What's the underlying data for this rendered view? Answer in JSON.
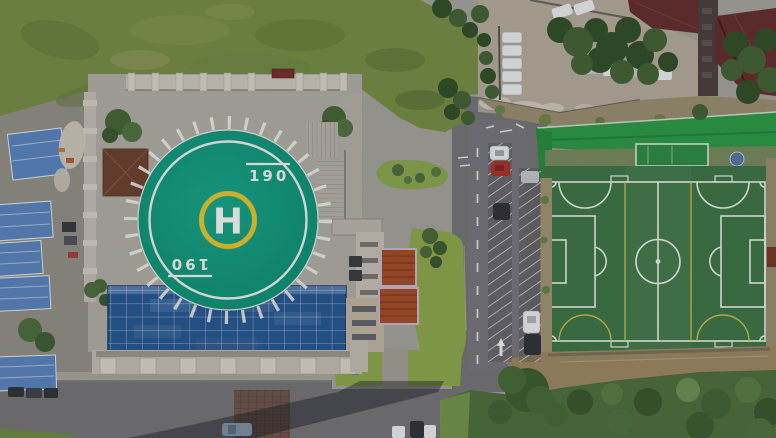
{
  "scene": {
    "kind": "aerial-drone-photo",
    "helipad": {
      "letter": "H",
      "heading_mark": "190"
    },
    "colors": {
      "base": "#a9a69f",
      "left_ground": "#96938c",
      "grass": "#7a9049",
      "lawn": "#92ab51",
      "island_green": "#8cab52",
      "turf": "#41784a",
      "line_white": "#eef3ea",
      "line_yellow": "#d8c94f",
      "enclosure_green": "#2f9d4b",
      "surround_green": "#7b8d60",
      "plaza": "#b3b0a9",
      "balustrade": "#cfcbc2",
      "stone_light": "#dad6cd",
      "helipad_teal": "#14997f",
      "helipad_yellow": "#e9c832",
      "glass_blue": "#2a5b95",
      "shed_blue": "#5d87c3",
      "maroon_roof": "#693131",
      "pagoda_orange": "#a9512c",
      "pavilion_brown": "#6f4533",
      "asphalt": "#78777b",
      "sidewalk": "#aca89f",
      "lot_concrete": "#b7ae9e",
      "rubble": "#d7d0c3",
      "dirt": "#a18b67",
      "dirt_strip": "#a39776",
      "shrub": "#50733f",
      "tree": "#47663a",
      "tree_dark": "#35522c",
      "brick": "#6f574d",
      "shadow": "rgba(24,28,38,0.42)",
      "car_white": "#edeff0",
      "car_silver": "#c6cacd",
      "car_red": "#b03431",
      "car_dark": "#33373c",
      "car_blue": "#7e93a7",
      "red_bench": "#7b3232",
      "equipment_red": "#7a3b2e"
    }
  }
}
